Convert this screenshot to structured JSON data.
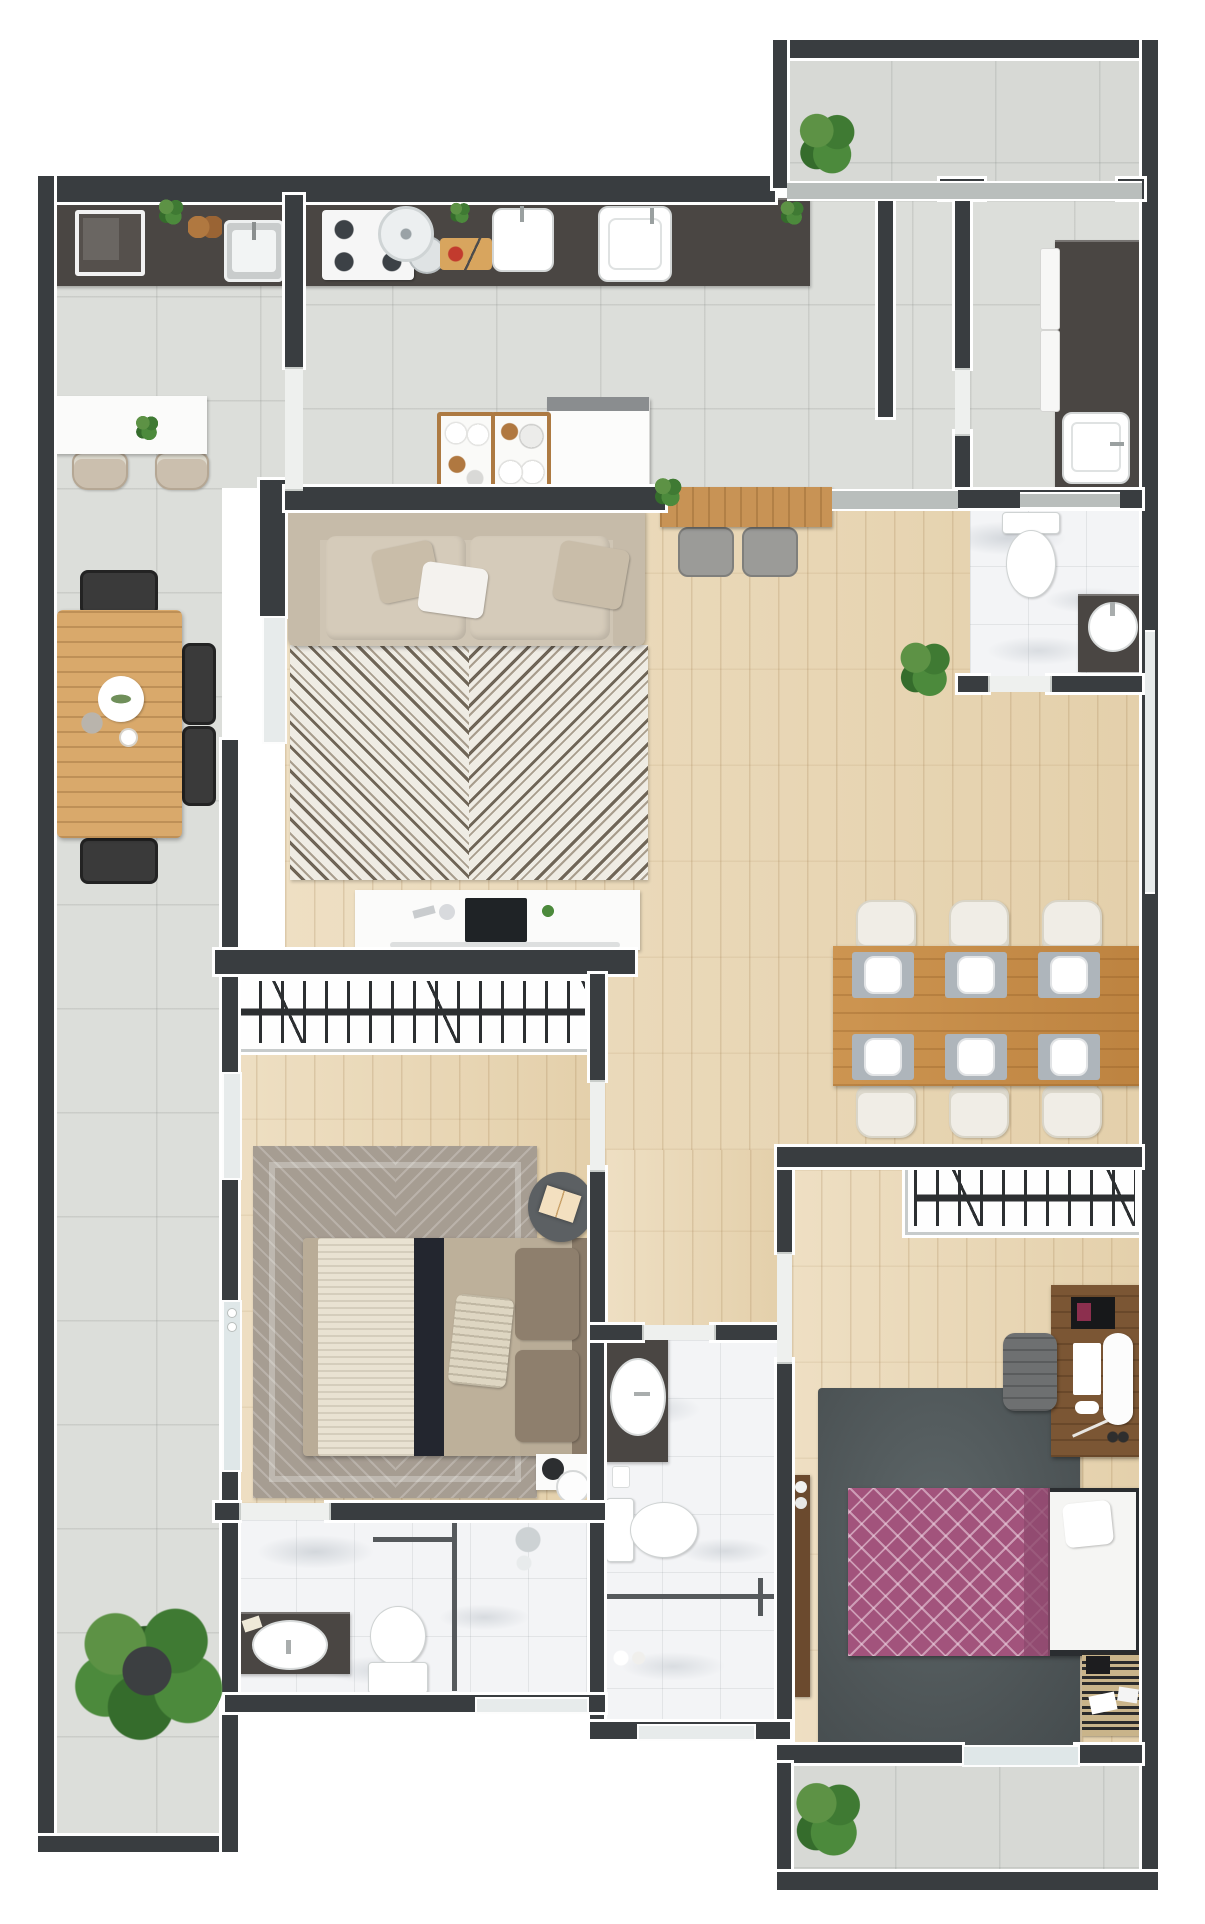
{
  "meta": {
    "kind": "architectural-floor-plan-render",
    "view": "top-down 3D render, no text labels",
    "canvas": {
      "width_px": 1205,
      "height_px": 1924
    }
  },
  "palette": {
    "background": "#ffffff",
    "wall_fill": "#393d40",
    "wall_outline": "#ffffff",
    "tile_floor": "#dcdeda",
    "wood_floor": "#ead9ba",
    "marble_floor": "#f3f4f6",
    "dark_counter": "#4a4643",
    "dining_table_wood": "#c48b47",
    "outdoor_table_wood": "#d9a96b",
    "sofa_beige": "#cfc5b4",
    "living_rug_light": "#efece4",
    "living_rug_dark": "#6f6557",
    "bedroom1_rug": "#a69d92",
    "bedroom2_rug": "#545b5d",
    "bedroom2_duvet_purple": "#a2537c",
    "plant_green": "#4c8a3c"
  },
  "rooms": [
    {
      "id": "terrace",
      "label": "Side terrace with gourmet counter and outdoor dining"
    },
    {
      "id": "kitchen",
      "label": "Kitchen with long counter, cooktop and double sinks"
    },
    {
      "id": "service",
      "label": "Laundry / service room with counter, sink and washers"
    },
    {
      "id": "balcony_top",
      "label": "Top balcony with plant"
    },
    {
      "id": "living",
      "label": "Living room with sofa, chevron rug and TV console"
    },
    {
      "id": "dining",
      "label": "Dining area with table for six"
    },
    {
      "id": "hallway",
      "label": "Hallway to bedrooms"
    },
    {
      "id": "bedroom1",
      "label": "Bedroom 1 with wardrobe, double bed and en-suite"
    },
    {
      "id": "bathroom1",
      "label": "En-suite bathroom 1 with vanity, toilet and shower"
    },
    {
      "id": "bathroom2",
      "label": "Bathroom 2 with vanity, toilet and shower"
    },
    {
      "id": "bathroom3",
      "label": "Guest WC with toilet and round-basin vanity"
    },
    {
      "id": "bedroom2",
      "label": "Bedroom 2 with wardrobe, desk and double bed"
    },
    {
      "id": "balcony_bottom",
      "label": "Bottom balcony with plant"
    }
  ],
  "furniture": {
    "terrace": [
      "gourmet dark counter",
      "built-in appliance",
      "stainless sink",
      "bread board",
      "white bar table with plant",
      "two beige chairs",
      "wooden outdoor table",
      "four black chairs",
      "decor plate with leaves",
      "large potted plant"
    ],
    "kitchen": [
      "dark counter run",
      "gas cooktop with pans",
      "pan lid",
      "cutting board with food",
      "two white sinks",
      "herb plants",
      "refrigerator",
      "two wooden serving trays with plates and cups",
      "wood bar counter with two stools and plant"
    ],
    "service": [
      "dark L-counter",
      "white sink",
      "stacked washer and dryer fronts"
    ],
    "living": [
      "three-seat beige sofa with cushions",
      "black-and-white chevron rug",
      "white media console with TV and soundbar",
      "round side table with book"
    ],
    "dining": [
      "wooden table",
      "six gray placemats with white plates",
      "six cream chairs",
      "potted plant"
    ],
    "bedroom1": [
      "hanger wardrobe strip",
      "gray chevron rug",
      "double bed with knit throw, navy runner and pillows",
      "round reading table",
      "bedside unit with robot vacuum",
      "window and glass door to terrace"
    ],
    "bathroom1": [
      "dark vanity with oval basin",
      "toilet",
      "glass shower partition",
      "shower set",
      "window"
    ],
    "bathroom2": [
      "dark vanity with oval vessel basin",
      "toilet",
      "glass shower partition",
      "bath amenities",
      "window"
    ],
    "bathroom3": [
      "toilet",
      "dark vanity with round basin"
    ],
    "bedroom2": [
      "hanger wardrobe",
      "walnut desk with monitor, keyboard and laptop",
      "office chair",
      "dark slate rug",
      "double bed with purple lattice duvet and white mattress side",
      "narrow wall shelf",
      "zigzag mat with cards"
    ],
    "balcony_top": [
      "potted plant"
    ],
    "balcony_bottom": [
      "potted plant"
    ]
  }
}
